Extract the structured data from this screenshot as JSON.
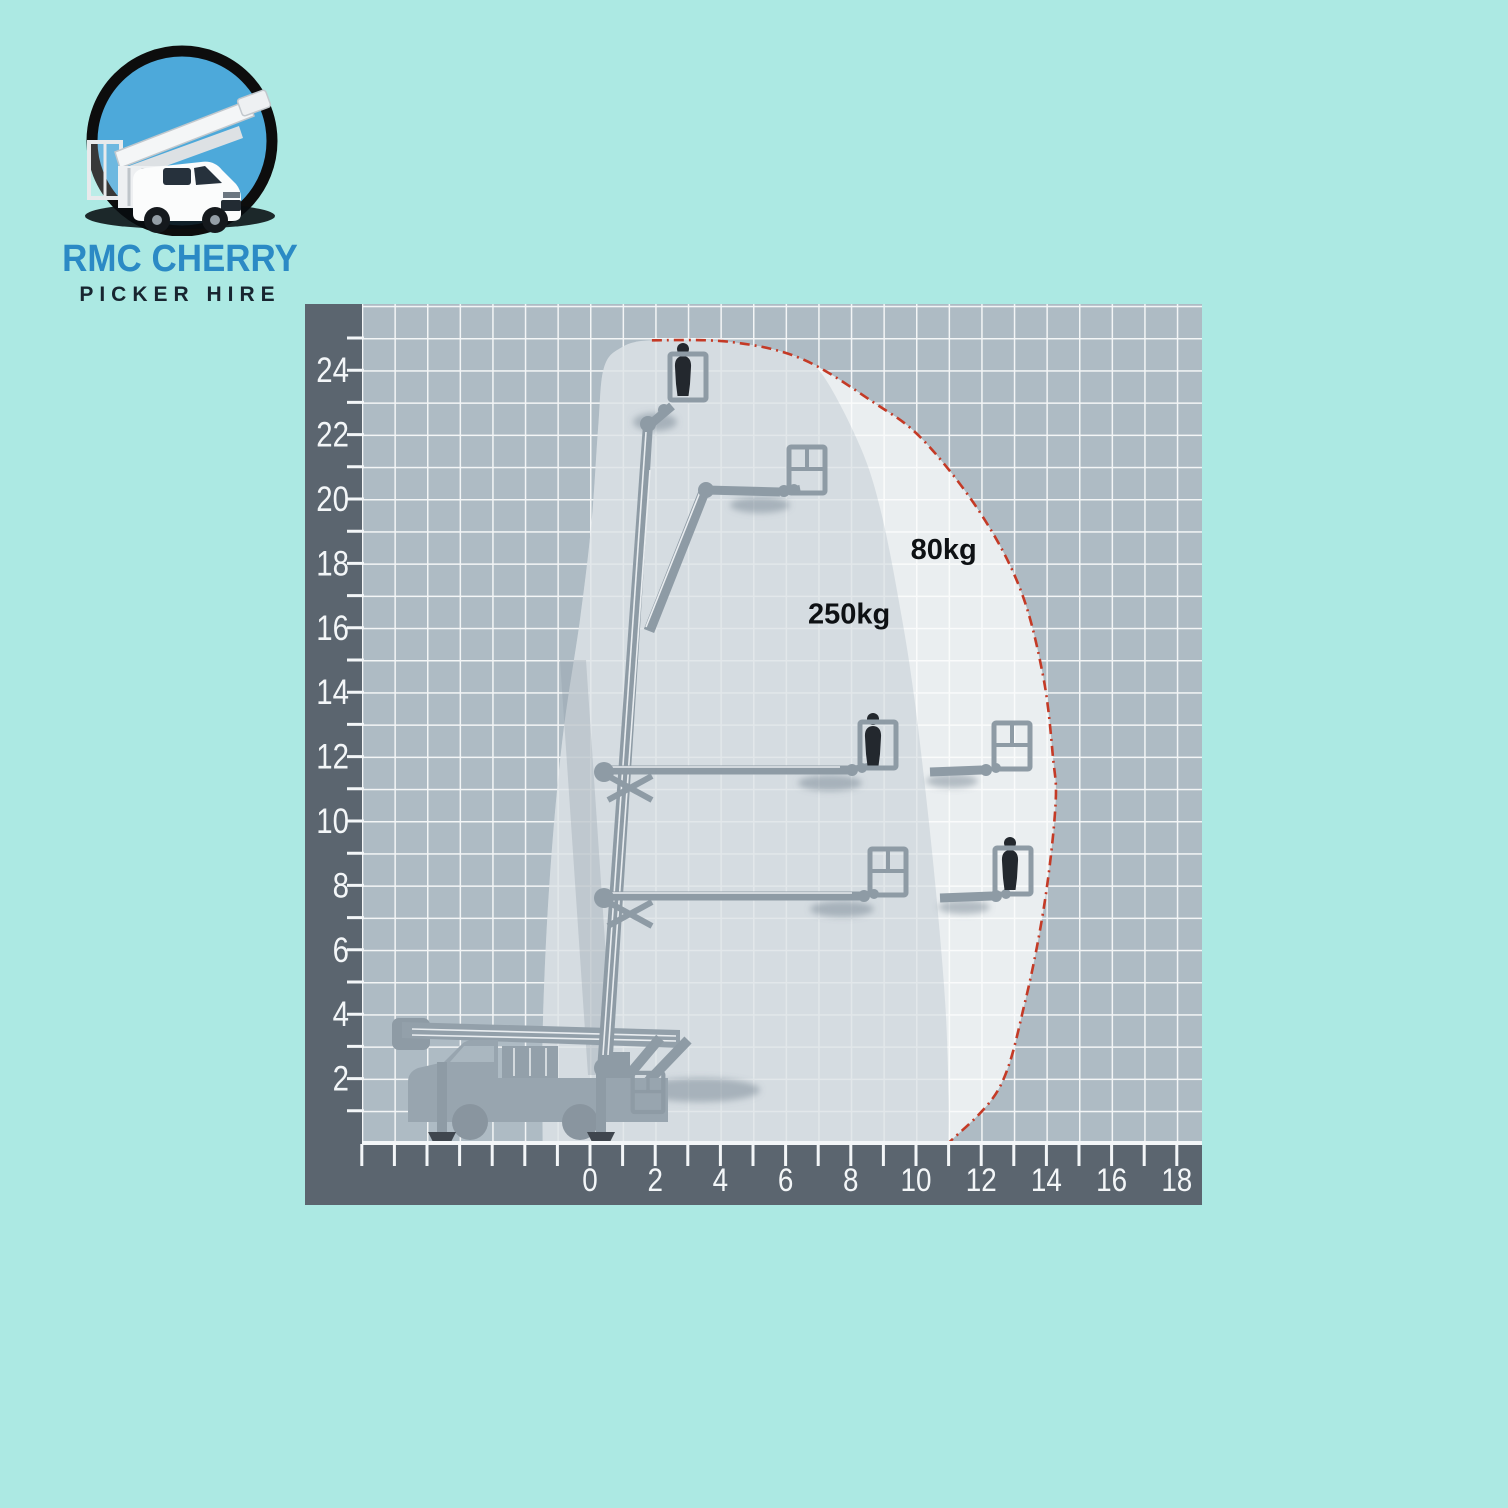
{
  "page": {
    "background": "#ace9e3",
    "width": 1508,
    "height": 1508
  },
  "logo": {
    "title": "RMC CHERRY",
    "subtitle": "PICKER HIRE",
    "title_color": "#2b8ac5",
    "subtitle_color": "#182530",
    "badge_sky": "#4da9da",
    "badge_ring": "#0d0d0d"
  },
  "chart_data": {
    "type": "area",
    "x_axis": {
      "labels": [
        0,
        2,
        4,
        6,
        8,
        10,
        12,
        14,
        16,
        18
      ],
      "minor_tick_step": 1,
      "range": [
        -7,
        18.8
      ],
      "unit": "m"
    },
    "y_axis": {
      "labels": [
        2,
        4,
        6,
        8,
        10,
        12,
        14,
        16,
        18,
        20,
        22,
        24
      ],
      "minor_tick_step": 1,
      "range": [
        0,
        26
      ],
      "unit": "m"
    },
    "zones": [
      {
        "label": "250kg",
        "label_pos": [
          7.95,
          16.45
        ]
      },
      {
        "label": "80kg",
        "label_pos": [
          10.85,
          18.45
        ]
      }
    ],
    "envelope_outline": [
      [
        -1.45,
        0
      ],
      [
        -1.45,
        3.5
      ],
      [
        -1.25,
        8
      ],
      [
        -0.85,
        12.5
      ],
      [
        -0.3,
        16.3
      ],
      [
        0.05,
        19.3
      ],
      [
        0.25,
        22.2
      ],
      [
        0.42,
        24.05
      ],
      [
        0.95,
        24.7
      ],
      [
        1.9,
        24.93
      ],
      [
        4.3,
        24.88
      ],
      [
        6.5,
        24.35
      ],
      [
        8.7,
        23.0
      ],
      [
        10.2,
        21.85
      ],
      [
        11.95,
        19.6
      ],
      [
        13.2,
        17.2
      ],
      [
        13.9,
        14.5
      ],
      [
        14.2,
        12.0
      ],
      [
        14.28,
        10.5
      ],
      [
        13.95,
        7.5
      ],
      [
        13.35,
        4.4
      ],
      [
        12.55,
        1.7
      ],
      [
        11.0,
        0
      ]
    ],
    "zone_250kg_outline": [
      [
        -1.45,
        0
      ],
      [
        -1.45,
        3.5
      ],
      [
        -1.25,
        8
      ],
      [
        -0.85,
        12.5
      ],
      [
        -0.3,
        16.3
      ],
      [
        0.05,
        19.3
      ],
      [
        0.25,
        22.2
      ],
      [
        0.42,
        24.05
      ],
      [
        0.95,
        24.7
      ],
      [
        1.9,
        24.93
      ],
      [
        4.3,
        24.88
      ],
      [
        6.2,
        24.45
      ],
      [
        7.1,
        23.9
      ],
      [
        8.3,
        21.6
      ],
      [
        8.95,
        19.5
      ],
      [
        9.55,
        16.4
      ],
      [
        9.95,
        13.8
      ],
      [
        10.35,
        10.4
      ],
      [
        10.65,
        7.4
      ],
      [
        10.9,
        4.3
      ],
      [
        11.0,
        1.5
      ],
      [
        11.0,
        0
      ]
    ],
    "max_reach_line": [
      [
        1.9,
        24.93
      ],
      [
        4.3,
        24.88
      ],
      [
        6.5,
        24.35
      ],
      [
        8.7,
        23.0
      ],
      [
        10.2,
        21.85
      ],
      [
        11.95,
        19.6
      ],
      [
        13.2,
        17.2
      ],
      [
        13.9,
        14.5
      ],
      [
        14.2,
        12.0
      ],
      [
        14.28,
        10.5
      ],
      [
        13.95,
        7.5
      ],
      [
        13.35,
        4.4
      ],
      [
        12.55,
        1.7
      ],
      [
        11.0,
        0
      ]
    ],
    "illustrated_positions": [
      {
        "outreach": 2.9,
        "height": 23.0,
        "basket": "occupied"
      },
      {
        "outreach": 6.6,
        "height": 20.2,
        "basket": "empty"
      },
      {
        "outreach": 8.7,
        "height": 11.6,
        "basket": "occupied"
      },
      {
        "outreach": 12.7,
        "height": 11.6,
        "basket": "empty"
      },
      {
        "outreach": 9.1,
        "height": 7.7,
        "basket": "empty"
      },
      {
        "outreach": 13.0,
        "height": 7.7,
        "basket": "occupied"
      }
    ],
    "colors": {
      "grid_bg": "#aebbc4",
      "grid_line": "#f3f5f6",
      "axis_band": "#5b656f",
      "axis_text": "#f3f6f8",
      "envelope_fill": "#fbfcfd",
      "zone_tint": "#8ba0ad",
      "max_reach_line_color": "#c43a26",
      "machine": "#8e9ba5",
      "person": "#23282e",
      "label_color": "#0e1114"
    }
  }
}
